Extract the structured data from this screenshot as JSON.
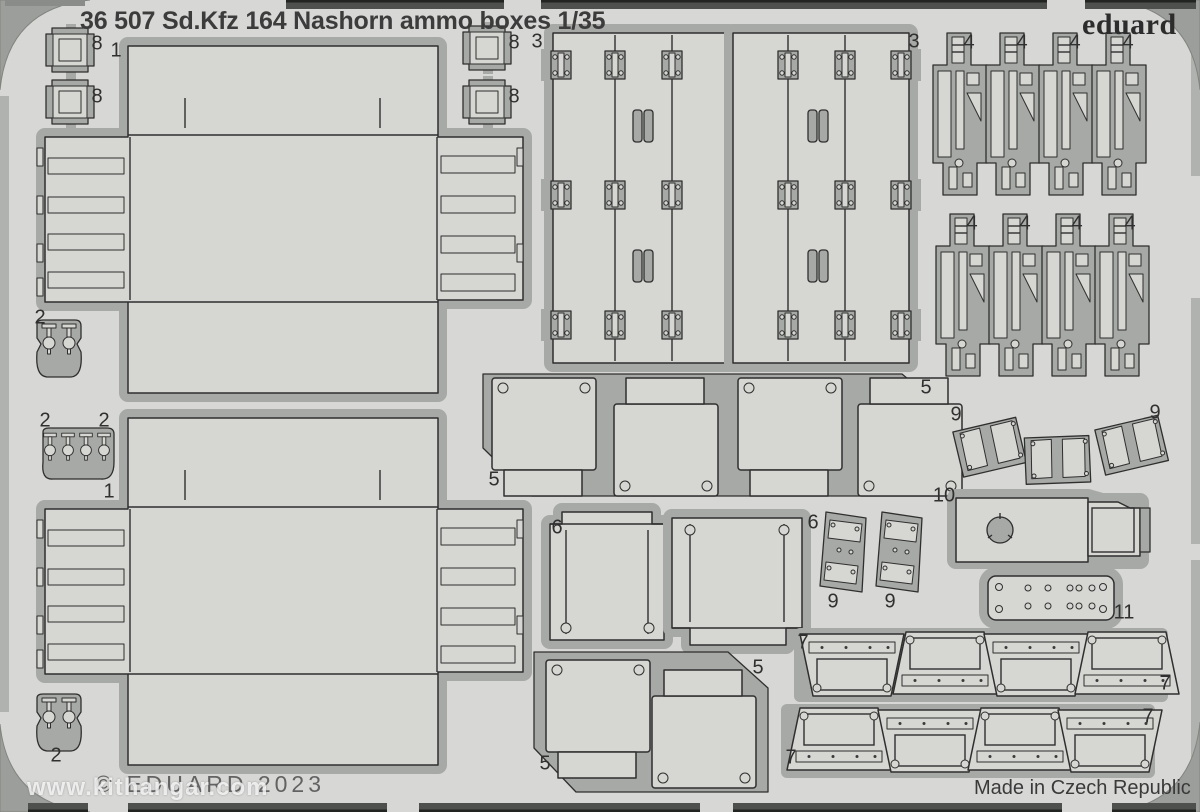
{
  "header": {
    "catalog_number": "36 507",
    "subject": "Sd.Kfz 164 Nashorn ammo boxes 1/35",
    "full_title": "36 507 Sd.Kfz 164 Nashorn ammo boxes 1/35",
    "brand": "eduard"
  },
  "footer": {
    "copyright": "© EDUARD 2023",
    "made_in": "Made in Czech Republic",
    "watermark": "www.kithangar.com"
  },
  "colors": {
    "sheet": "#d7d8d5",
    "part_fill": "#d6d7d3",
    "sprue": "#a6a9a5",
    "outline": "#2f2f2f",
    "photo_background": "#9c9e9b",
    "edge_bar": "#4e504e",
    "text": "#3c3c3c",
    "watermark_text": "#ffffff"
  },
  "part_labels": [
    {
      "text": "8",
      "x": 97,
      "y": 44
    },
    {
      "text": "8",
      "x": 97,
      "y": 97
    },
    {
      "text": "8",
      "x": 514,
      "y": 43
    },
    {
      "text": "8",
      "x": 514,
      "y": 97
    },
    {
      "text": "1",
      "x": 116,
      "y": 51
    },
    {
      "text": "1",
      "x": 109,
      "y": 492
    },
    {
      "text": "3",
      "x": 537,
      "y": 42
    },
    {
      "text": "3",
      "x": 914,
      "y": 42
    },
    {
      "text": "4",
      "x": 969,
      "y": 43
    },
    {
      "text": "4",
      "x": 1022,
      "y": 43
    },
    {
      "text": "4",
      "x": 1075,
      "y": 43
    },
    {
      "text": "4",
      "x": 1128,
      "y": 43
    },
    {
      "text": "4",
      "x": 972,
      "y": 224
    },
    {
      "text": "4",
      "x": 1025,
      "y": 224
    },
    {
      "text": "4",
      "x": 1077,
      "y": 224
    },
    {
      "text": "4",
      "x": 1130,
      "y": 224
    },
    {
      "text": "2",
      "x": 40,
      "y": 318
    },
    {
      "text": "2",
      "x": 45,
      "y": 421
    },
    {
      "text": "2",
      "x": 104,
      "y": 421
    },
    {
      "text": "2",
      "x": 56,
      "y": 756
    },
    {
      "text": "5",
      "x": 494,
      "y": 480
    },
    {
      "text": "5",
      "x": 926,
      "y": 388
    },
    {
      "text": "5",
      "x": 545,
      "y": 764
    },
    {
      "text": "5",
      "x": 758,
      "y": 668
    },
    {
      "text": "9",
      "x": 956,
      "y": 415
    },
    {
      "text": "9",
      "x": 1155,
      "y": 413
    },
    {
      "text": "9",
      "x": 833,
      "y": 602
    },
    {
      "text": "9",
      "x": 890,
      "y": 602
    },
    {
      "text": "10",
      "x": 944,
      "y": 496
    },
    {
      "text": "11",
      "x": 1124,
      "y": 613
    },
    {
      "text": "6",
      "x": 557,
      "y": 528
    },
    {
      "text": "6",
      "x": 813,
      "y": 523
    },
    {
      "text": "7",
      "x": 803,
      "y": 643
    },
    {
      "text": "7",
      "x": 1165,
      "y": 684
    },
    {
      "text": "7",
      "x": 1148,
      "y": 717
    },
    {
      "text": "7",
      "x": 791,
      "y": 758
    }
  ]
}
